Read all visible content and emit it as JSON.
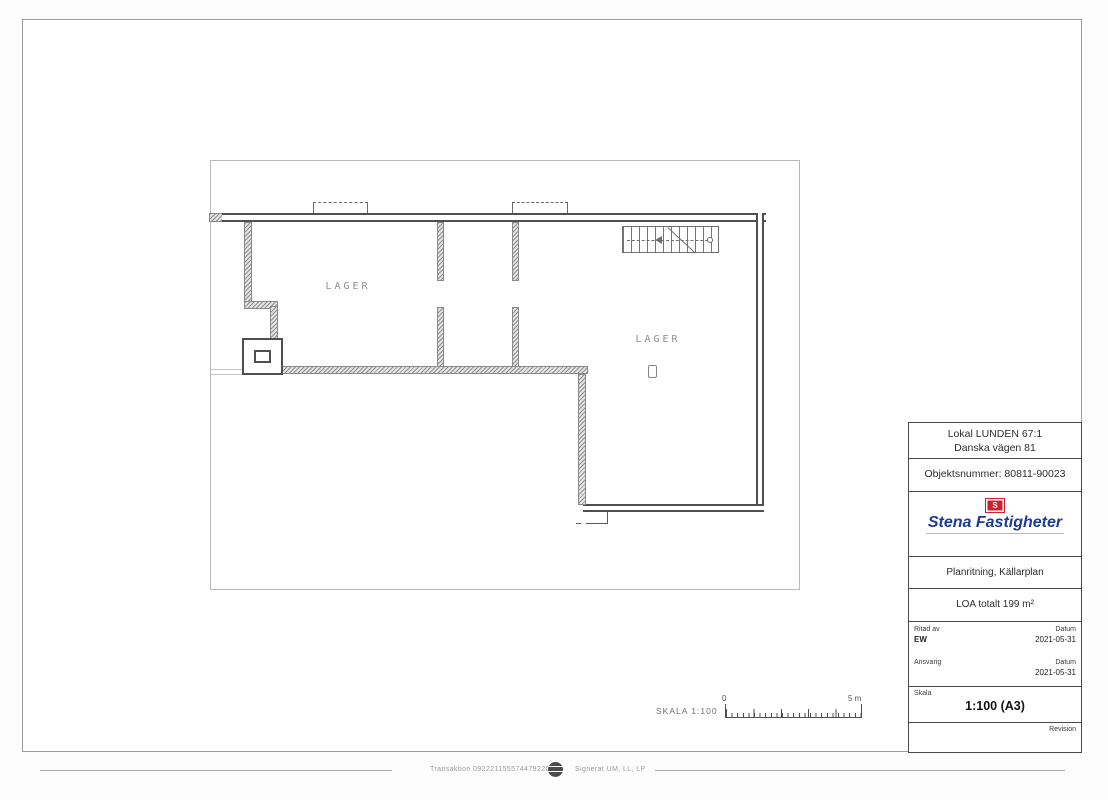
{
  "plan": {
    "rooms": [
      {
        "label": "LAGER"
      },
      {
        "label": "LAGER"
      }
    ],
    "markers": [
      {
        "name": "column-marker"
      }
    ]
  },
  "scale_bar": {
    "label": "SKALA 1:100",
    "start_value": "0",
    "end_value": "5 m"
  },
  "title_block": {
    "site_line1": "Lokal LUNDEN 67:1",
    "site_line2": "Danska vägen 81",
    "object_number": "Objektsnummer: 80811-90023",
    "brand": {
      "name": "Stena Fastigheter",
      "initial": "S",
      "blue": "#1d3b96",
      "red": "#cf2030"
    },
    "drawing_title": "Planritning, Källarplan",
    "area_total": "LOA totalt 199 m²",
    "drawn_by_label": "Ritad av",
    "drawn_by_value": "EW",
    "date_label": "Datum",
    "drawn_date": "2021-05-31",
    "responsible_label": "Ansvarig",
    "responsible_date": "2021-05-31",
    "scale_label": "Skala",
    "scale_value": "1:100 (A3)",
    "revision_label": "Revision"
  },
  "footer": {
    "transaction": "Transaktion 09222115557447922043",
    "signed": "Signerat UM, LL, LP"
  }
}
